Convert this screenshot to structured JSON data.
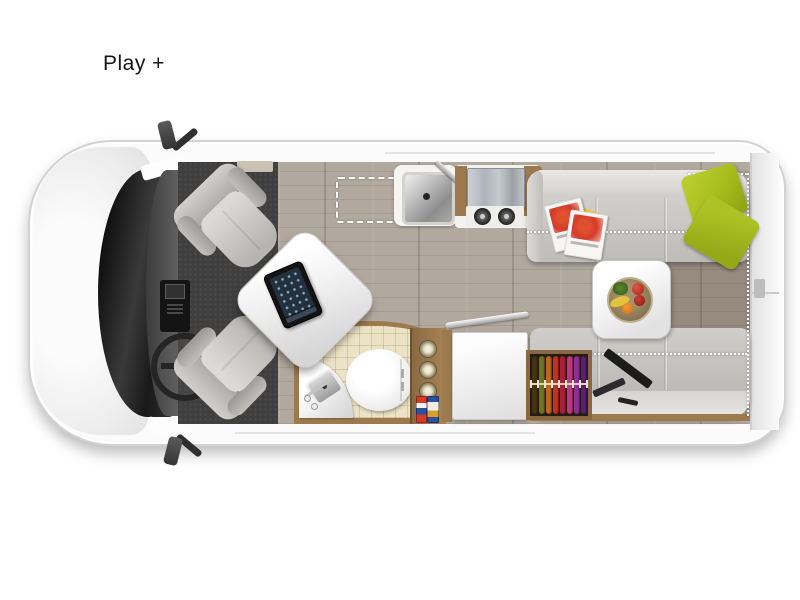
{
  "page": {
    "title": "Play +"
  },
  "colors": {
    "accent-green": "#a7bd1d",
    "sofa": "#c6c5c1",
    "wood-floor": "#b2a99e",
    "wood-trim": "#9c7a4e",
    "carpet": "#3f3f3f",
    "tile": "#ece3c6",
    "van-white": "#fbfbfb",
    "dashed": "#ffffff"
  },
  "floorplan": {
    "wardrobe_clothes_css": [
      "background:#453414",
      "background:#6d7426",
      "background:#c2641f",
      "background:#c03222",
      "background:#a8203c",
      "background:#c2387c",
      "background:#8c2f96",
      "background:#55206e"
    ]
  }
}
